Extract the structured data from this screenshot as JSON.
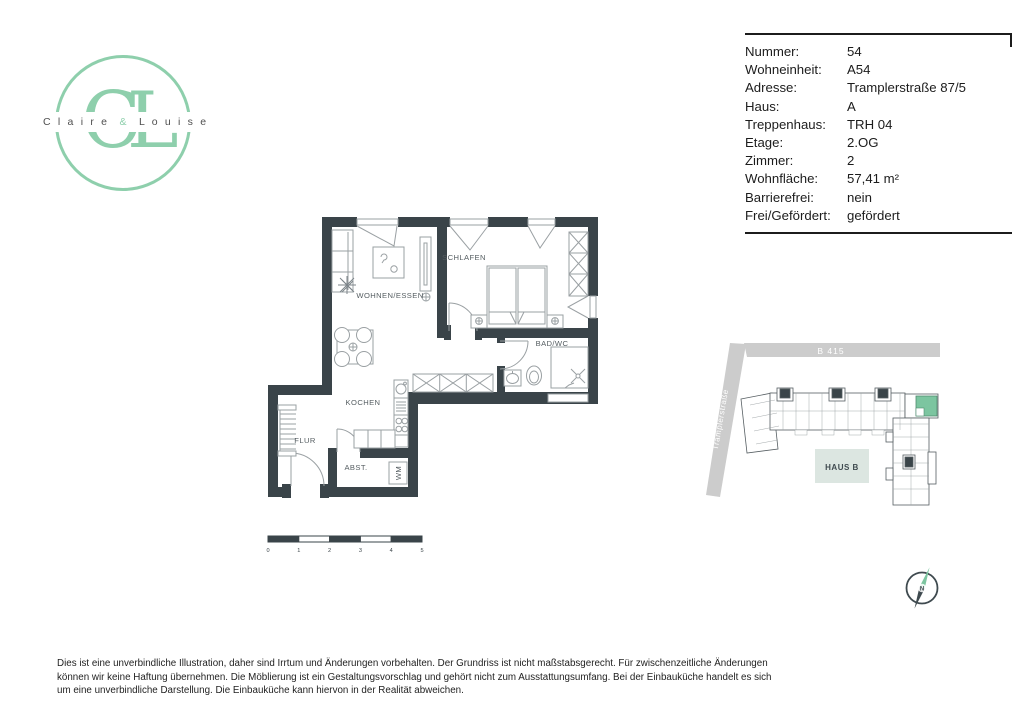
{
  "logo": {
    "monogram": "CL",
    "name_left": "C l a i r e",
    "amp": "&",
    "name_right": "L o u i s e"
  },
  "info_table": {
    "rows": [
      {
        "label": "Nummer:",
        "value": "54"
      },
      {
        "label": "Wohneinheit:",
        "value": "A54"
      },
      {
        "label": "Adresse:",
        "value": "Tramplerstraße 87/5"
      },
      {
        "label": "Haus:",
        "value": "A"
      },
      {
        "label": "Treppenhaus:",
        "value": "TRH 04"
      },
      {
        "label": "Etage:",
        "value": "2.OG"
      },
      {
        "label": "Zimmer:",
        "value": "2"
      },
      {
        "label": "Wohnfläche:",
        "value": "57,41 m²"
      },
      {
        "label": "Barrierefrei:",
        "value": "nein"
      },
      {
        "label": "Frei/Gefördert:",
        "value": "gefördert"
      }
    ]
  },
  "floorplan": {
    "rooms": {
      "wohnen": "WOHNEN/ESSEN",
      "schlafen": "SCHLAFEN",
      "bad": "BAD/WC",
      "kochen": "KOCHEN",
      "flur": "FLUR",
      "abst": "ABST.",
      "wm": "WM"
    }
  },
  "scalebar": {
    "ticks": [
      "0",
      "1",
      "2",
      "3",
      "4",
      "5"
    ]
  },
  "siteplan": {
    "road_main": "B 415",
    "road_side": "Tramplerstraße",
    "building_label": "HAUS B",
    "compass_n": "N"
  },
  "footer": {
    "disclaimer": "Dies ist eine unverbindliche Illustration, daher sind Irrtum und Änderungen vorbehalten. Der Grundriss ist nicht maßstabsgerecht. Für zwischenzeitliche Änderungen können wir keine Haftung übernehmen. Die Möblierung ist ein Gestaltungsvorschlag und gehört nicht zum Ausstattungsumfang. Bei der Einbauküche handelt es sich um eine unverbindliche Darstellung. Die Einbauküche kann hiervon in der Realität abweichen."
  },
  "colors": {
    "wall": "#3a4449",
    "mint": "#8ecfac",
    "unit_highlight": "#7cc5a0",
    "road": "#cccccc",
    "furniture_line": "#9aa0a3"
  }
}
